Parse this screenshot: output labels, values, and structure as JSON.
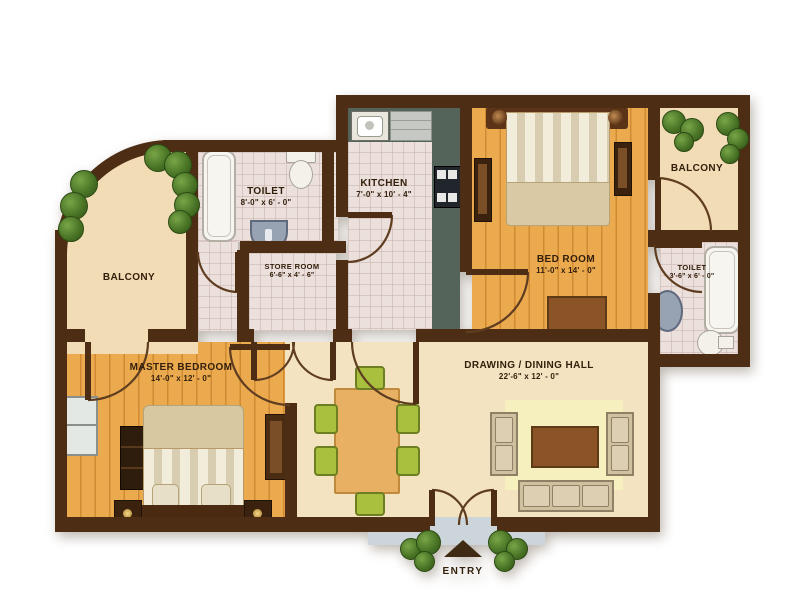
{
  "title": "Apartment Floor Plan",
  "rooms": {
    "balcony_left": {
      "label": "BALCONY"
    },
    "toilet_left": {
      "label": "TOILET",
      "dims": "8'-0\" x 6' - 0\""
    },
    "store": {
      "label": "STORE ROOM",
      "dims": "6'-6\" x 4' - 6\""
    },
    "kitchen": {
      "label": "KITCHEN",
      "dims": "7'-0\" x 10' - 4\""
    },
    "bedroom": {
      "label": "BED ROOM",
      "dims": "11'-0\" x 14' - 0\""
    },
    "balcony_right": {
      "label": "BALCONY"
    },
    "toilet_right": {
      "label": "TOILET",
      "dims": "3'-6\" x 6' - 0\""
    },
    "master": {
      "label": "MASTER BEDROOM",
      "dims": "14'-0\" x 12' - 0\""
    },
    "hall": {
      "label": "DRAWING / DINING HALL",
      "dims": "22'-6\" x 12' - 0\""
    }
  },
  "entry": {
    "label": "ENTRY"
  },
  "colors": {
    "wall": "#4e2d15",
    "wood": "#ecaa4f",
    "beige": "#f4e3c1",
    "balcony": "#f2dcb6",
    "tile": "#ece0dd",
    "counter": "#55645a",
    "chair_green": "#a9bf3e",
    "rug": "#f6efbe",
    "table_wood": "#e7b063",
    "sofa": "#cfc0a0",
    "coffee_table": "#8a5426",
    "bush": "#4a7526",
    "porch": "#ccd6da",
    "text": "#33200c"
  }
}
